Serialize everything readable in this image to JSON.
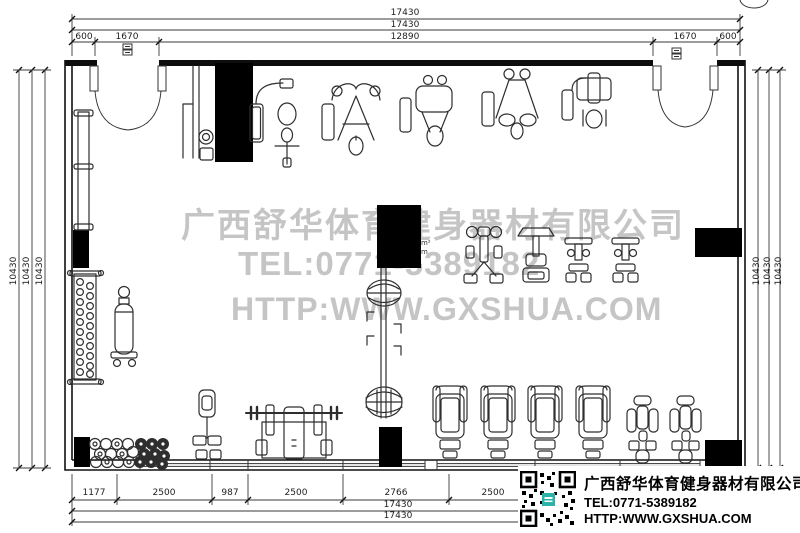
{
  "watermark": {
    "company": "广西舒华体育健身器材有限公司",
    "tel": "TEL:0771-5389182",
    "website": "HTTP:WWW.GXSHUA.COM"
  },
  "info_block": {
    "company": "广西舒华体育健身器材有限公司",
    "tel": "TEL:0771-5389182",
    "website": "HTTP:WWW.GXSHUA.COM"
  },
  "area_label": {
    "line1": "m²",
    "line2": "m"
  },
  "colors": {
    "line": "#111111",
    "watermark": "#c5c5c5",
    "column_fill": "#000000",
    "qr_accent": "#2bb3aa"
  },
  "dimension_labels": [
    {
      "text": "17430",
      "x": 405,
      "y": 13,
      "rot": 0
    },
    {
      "text": "17430",
      "x": 405,
      "y": 25,
      "rot": 0
    },
    {
      "text": "12890",
      "x": 405,
      "y": 37,
      "rot": 0
    },
    {
      "text": "600",
      "x": 84,
      "y": 37,
      "rot": 0
    },
    {
      "text": "1670",
      "x": 127,
      "y": 37,
      "rot": 0
    },
    {
      "text": "1670",
      "x": 685,
      "y": 37,
      "rot": 0
    },
    {
      "text": "600",
      "x": 728,
      "y": 37,
      "rot": 0
    },
    {
      "text": "10430",
      "x": 14,
      "y": 271,
      "rot": 1
    },
    {
      "text": "10430",
      "x": 27,
      "y": 271,
      "rot": 1
    },
    {
      "text": "10430",
      "x": 40,
      "y": 271,
      "rot": 1
    },
    {
      "text": "10430",
      "x": 757,
      "y": 271,
      "rot": 1
    },
    {
      "text": "10430",
      "x": 768,
      "y": 271,
      "rot": 1
    },
    {
      "text": "10430",
      "x": 779,
      "y": 271,
      "rot": 1
    },
    {
      "text": "1177",
      "x": 94,
      "y": 493,
      "rot": 0
    },
    {
      "text": "2500",
      "x": 164,
      "y": 493,
      "rot": 0
    },
    {
      "text": "987",
      "x": 230,
      "y": 493,
      "rot": 0
    },
    {
      "text": "2500",
      "x": 296,
      "y": 493,
      "rot": 0
    },
    {
      "text": "2766",
      "x": 396,
      "y": 493,
      "rot": 0
    },
    {
      "text": "2500",
      "x": 493,
      "y": 493,
      "rot": 0
    },
    {
      "text": "17430",
      "x": 398,
      "y": 505,
      "rot": 0
    },
    {
      "text": "17430",
      "x": 398,
      "y": 516,
      "rot": 0
    }
  ]
}
